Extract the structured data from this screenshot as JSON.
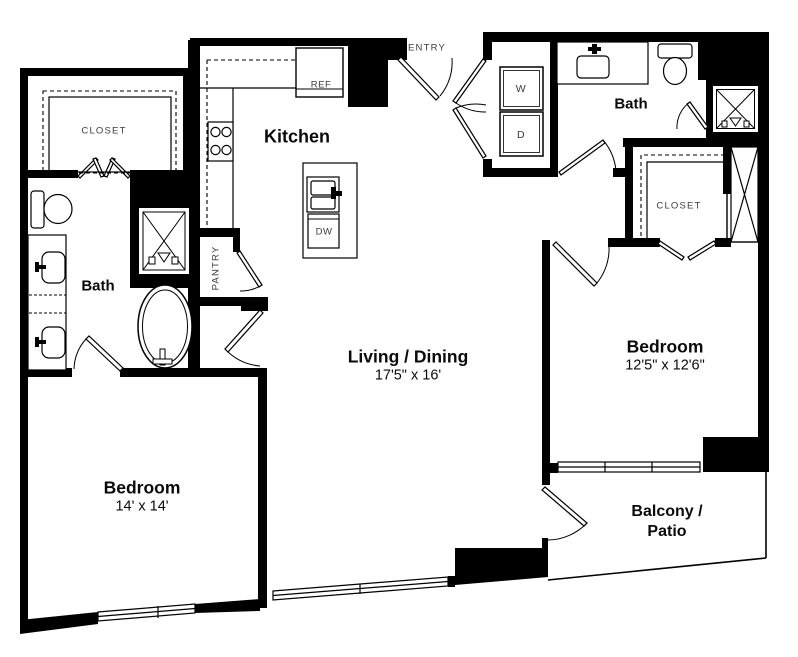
{
  "plan": {
    "title": "Two bedroom two bath apartment floor plan",
    "colors": {
      "wall": "#000000",
      "background": "#ffffff"
    },
    "rooms": {
      "kitchen": {
        "label": "Kitchen"
      },
      "entry": {
        "label": "ENTRY"
      },
      "pantry": {
        "label": "PANTRY"
      },
      "closet_left": {
        "label": "CLOSET"
      },
      "closet_right": {
        "label": "CLOSET"
      },
      "bath_left": {
        "label": "Bath"
      },
      "bath_right": {
        "label": "Bath"
      },
      "living": {
        "label": "Living / Dining",
        "dims": "17'5\" x 16'"
      },
      "bedroom_left": {
        "label": "Bedroom",
        "dims": "14' x 14'"
      },
      "bedroom_right": {
        "label": "Bedroom",
        "dims": "12'5\" x 12'6\""
      },
      "balcony": {
        "label_line1": "Balcony /",
        "label_line2": "Patio"
      }
    },
    "appliances": {
      "refrigerator": {
        "label": "REF"
      },
      "dishwasher": {
        "label": "DW"
      },
      "washer": {
        "label": "W"
      },
      "dryer": {
        "label": "D"
      }
    }
  }
}
